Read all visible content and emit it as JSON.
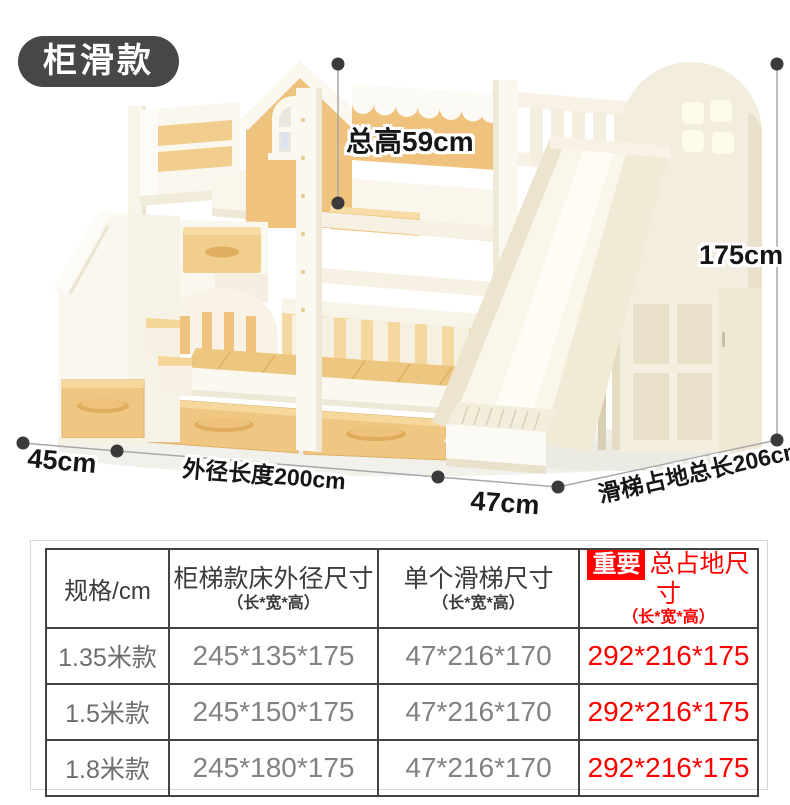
{
  "badge": {
    "label": "柜滑款"
  },
  "annotations": {
    "total_height": "总高59cm",
    "right_height": "175cm",
    "left_depth": "45cm",
    "outer_length": "外径长度200cm",
    "slide_width": "47cm",
    "slide_floor_length": "滑梯占地总长206cm"
  },
  "table": {
    "columns": {
      "spec": "规格/cm",
      "bed_title": "柜梯款床外径尺寸",
      "bed_sub": "（长*宽*高）",
      "slide_title": "单个滑梯尺寸",
      "slide_sub": "（长*宽*高）",
      "total_badge": "重要",
      "total_title": "总占地尺寸",
      "total_sub": "（长*宽*高）"
    },
    "rows": [
      {
        "spec": "1.35米款",
        "bed": "245*135*175",
        "slide": "47*216*170",
        "total": "292*216*175"
      },
      {
        "spec": "1.5米款",
        "bed": "245*150*175",
        "slide": "47*216*170",
        "total": "292*216*175"
      },
      {
        "spec": "1.8米款",
        "bed": "245*180*175",
        "slide": "47*216*170",
        "total": "292*216*175"
      }
    ]
  },
  "colors": {
    "accent_red": "#fe0000",
    "badge_bg": "#474747",
    "wood": "#f0c782",
    "cream": "#f8f4ea",
    "table_border": "#424242",
    "dim_line": "#a8a8a8",
    "dim_dot": "#3a3a3a"
  }
}
